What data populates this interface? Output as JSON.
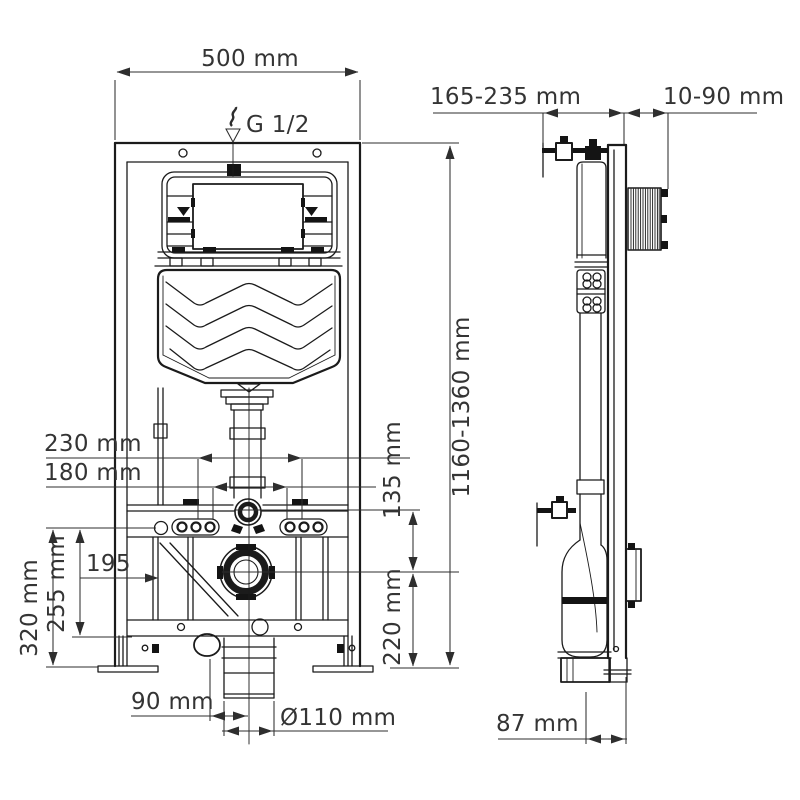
{
  "title": "Wall-hung WC installation frame technical drawing",
  "colors": {
    "ink": "#1b1b1b",
    "background": "#ffffff"
  },
  "drawing": {
    "front": {
      "width": "500 mm",
      "supply_thread": "G 1/2",
      "height_range": "1160-1360 mm",
      "fixing_spacing_outer": "230 mm",
      "fixing_spacing_inner": "180 mm",
      "flush_to_outlet": "135 mm",
      "outlet_center_height": "220 mm",
      "brace_offset": "195",
      "plate_zone_height": "255 mm",
      "lower_zone_height": "320 mm",
      "drain_side_offset": "90 mm",
      "drain_diameter": "Ø110 mm"
    },
    "side": {
      "depth_range": "165-235 mm",
      "wall_offset_range": "10-90 mm",
      "outlet_depth": "87 mm"
    }
  }
}
